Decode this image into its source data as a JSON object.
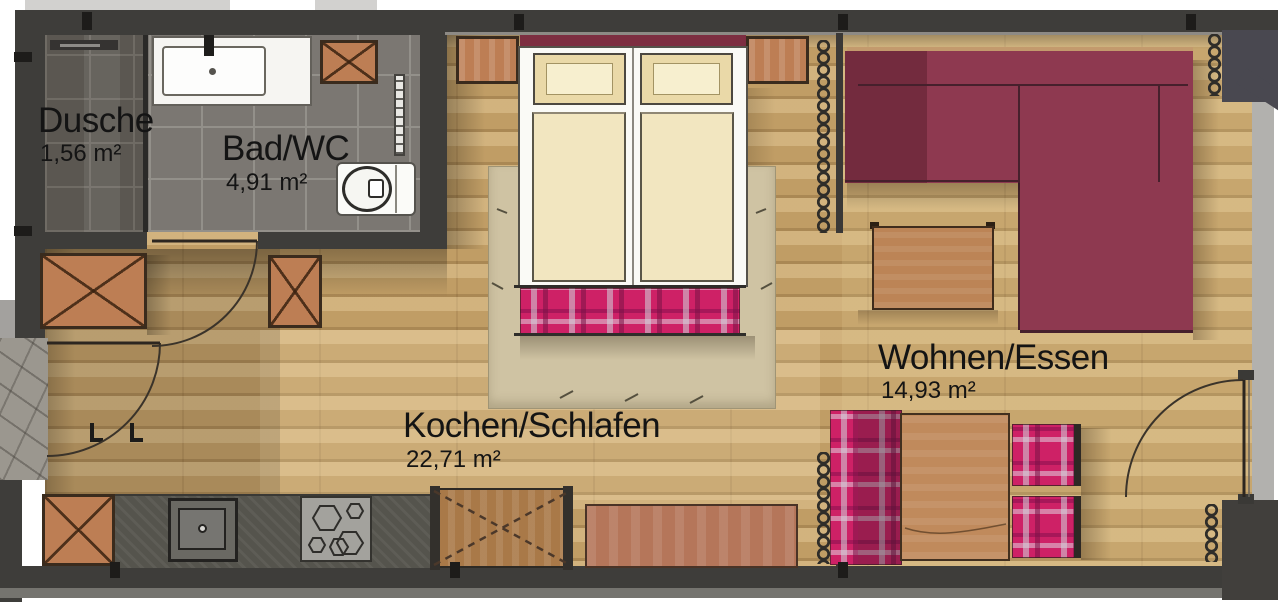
{
  "plan_title": "Apartment floor plan",
  "rooms": [
    {
      "name": "Dusche",
      "area": "1,56 m²"
    },
    {
      "name": "Bad/WC",
      "area": "4,91 m²"
    },
    {
      "name": "Kochen/Schlafen",
      "area": "22,71 m²"
    },
    {
      "name": "Wohnen/Essen",
      "area": "14,93 m²"
    }
  ],
  "colors": {
    "wall": "#3e3d3a",
    "wood_floor": "#c09d65",
    "bath_tile": "#7b7772",
    "shower_tile": "#5b5751",
    "rug": "#cfc3a3",
    "sofa": "#8e3950",
    "headboard": "#7d2e41",
    "plaid_fabric": "#ce2166",
    "bed_linen": "#f1e4bd",
    "kitchen_counter": "#55544d",
    "furniture_wood": "#bd7e54",
    "stone_entry": "#9b978f"
  },
  "fixtures": [
    "shower",
    "washbasin",
    "toilet",
    "towel-radiator",
    "wardrobe",
    "timber-column",
    "kitchen-counter",
    "kitchen-sink",
    "cooktop",
    "tall-cabinet",
    "sideboard",
    "double-bed",
    "nightstand",
    "foot-bench",
    "rug",
    "corner-sofa",
    "coffee-table",
    "dining-table",
    "dining-bench",
    "dining-chair",
    "radiator-coil",
    "entry-door",
    "bath-door",
    "balcony-door"
  ]
}
